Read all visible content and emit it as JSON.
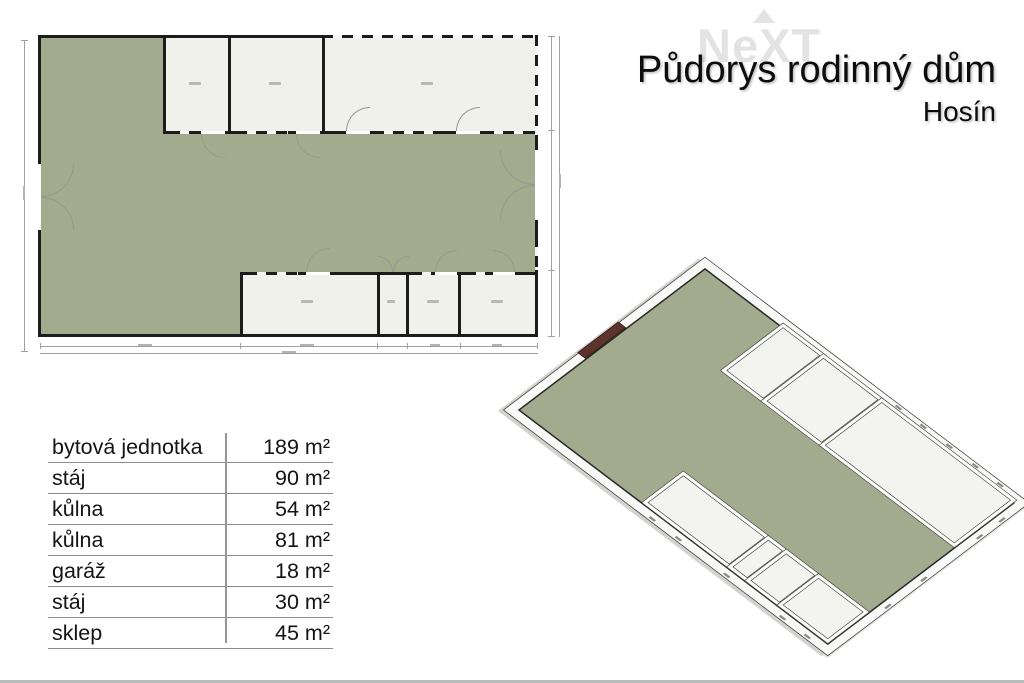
{
  "header": {
    "watermark": "NeXT",
    "title": "Půdorys rodinný dům",
    "subtitle": "Hosín"
  },
  "area_table": {
    "rows": [
      {
        "label": "bytová jednotka",
        "value": "189 m²"
      },
      {
        "label": "stáj",
        "value": "90 m²"
      },
      {
        "label": "kůlna",
        "value": "54 m²"
      },
      {
        "label": "kůlna",
        "value": "81 m²"
      },
      {
        "label": "garáž",
        "value": "18 m²"
      },
      {
        "label": "stáj",
        "value": "30 m²"
      },
      {
        "label": "sklep",
        "value": "45 m²"
      }
    ]
  },
  "colors": {
    "floor-green": "#a3ab8e",
    "room-white": "#f1f1ec",
    "wall-black": "#1c1c1c",
    "door-brown": "#5d342c",
    "watermark-gray": "#e3e3e3",
    "dim-gray": "#a0a0a0",
    "table-line-gray": "#8c8c8c",
    "bottom-bar": "#b7bbba",
    "wall3d-face": "#fcfcfa",
    "wall3d-edge": "#45453f",
    "slab-white": "#f9f9f7"
  }
}
